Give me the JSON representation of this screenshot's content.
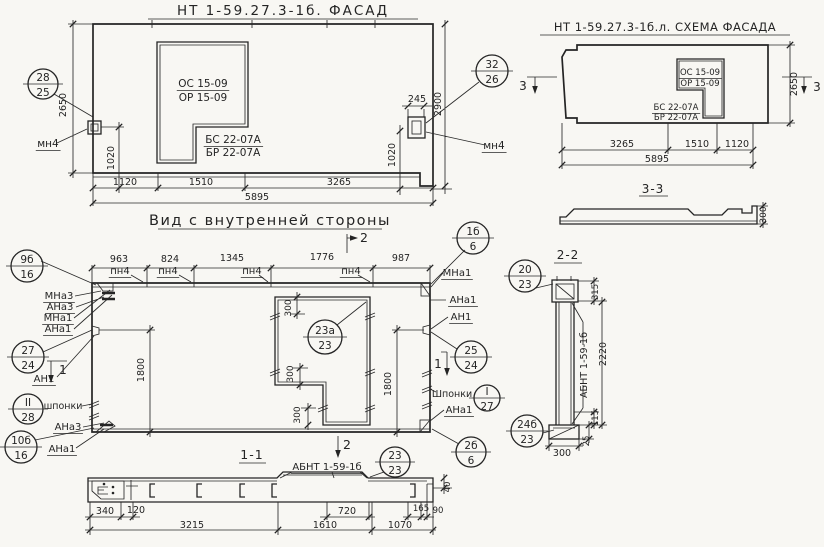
{
  "meta": {
    "drawing_type": "panel working drawing (facade, inner view, sections)",
    "paper_color": "#f8f7f3",
    "ink_color": "#242424"
  },
  "labels": [
    {
      "id": "title-facade",
      "text": "НТ 1-59.27.3-1б. ФАСАД",
      "x": 283,
      "y": 15,
      "size": 13.5,
      "ls": 2
    },
    {
      "id": "title-scheme",
      "text": "НТ 1-59.27.3-1б.л. СХЕМА ФАСАДА",
      "x": 665,
      "y": 31,
      "size": 11.5,
      "ls": 0.5
    },
    {
      "id": "title-inner-view",
      "text": "Вид с внутренней стороны",
      "x": 270,
      "y": 225,
      "size": 14.5,
      "ls": 1.5
    },
    {
      "id": "title-section-1-1",
      "text": "1-1",
      "x": 252,
      "y": 459,
      "size": 12.5,
      "ls": 1
    },
    {
      "id": "title-section-2-2",
      "text": "2-2",
      "x": 568,
      "y": 259,
      "size": 12,
      "ls": 1
    },
    {
      "id": "title-section-3-3",
      "text": "3-3",
      "x": 653,
      "y": 193,
      "size": 12,
      "ls": 1
    },
    {
      "id": "facade-os-mark",
      "text": "ОС 15-09",
      "x": 203,
      "y": 87,
      "size": 10.5,
      "u": true
    },
    {
      "id": "facade-or-mark",
      "text": "ОР 15-09",
      "x": 203,
      "y": 101,
      "size": 10.5
    },
    {
      "id": "facade-bs-mark",
      "text": "БС 22-07А",
      "x": 233,
      "y": 143,
      "size": 10.5,
      "u": true
    },
    {
      "id": "facade-br-mark",
      "text": "БР 22-07А",
      "x": 233,
      "y": 156,
      "size": 10.5
    },
    {
      "id": "facade-mn4-left",
      "text": "мн4",
      "x": 48,
      "y": 147,
      "size": 10.5,
      "u": true
    },
    {
      "id": "facade-mn4-right",
      "text": "мн4",
      "x": 494,
      "y": 149,
      "size": 10.5,
      "u": true
    },
    {
      "id": "facade-dim-1120",
      "text": "1120",
      "x": 125,
      "y": 185,
      "size": 9.5
    },
    {
      "id": "facade-dim-1510",
      "text": "1510",
      "x": 201,
      "y": 185,
      "size": 9.5
    },
    {
      "id": "facade-dim-3265",
      "text": "3265",
      "x": 339,
      "y": 185,
      "size": 9.5
    },
    {
      "id": "facade-dim-5895",
      "text": "5895",
      "x": 257,
      "y": 200,
      "size": 9.5
    },
    {
      "id": "facade-dim-2650",
      "text": "2650",
      "x": 66,
      "y": 105,
      "size": 9.5,
      "rot": -90
    },
    {
      "id": "facade-dim-1020-left",
      "text": "1020",
      "x": 114,
      "y": 158,
      "size": 9.5,
      "rot": -90
    },
    {
      "id": "facade-dim-245",
      "text": "245",
      "x": 417,
      "y": 102,
      "size": 9.5
    },
    {
      "id": "facade-dim-2900",
      "text": "2900",
      "x": 441,
      "y": 104,
      "size": 9.5,
      "rot": -90
    },
    {
      "id": "facade-dim-1020-right",
      "text": "1020",
      "x": 395,
      "y": 155,
      "size": 9.5,
      "rot": -90
    },
    {
      "id": "scheme-os-mark",
      "text": "ОС 15-09",
      "x": 700,
      "y": 75,
      "size": 8.5,
      "u": true
    },
    {
      "id": "scheme-or-mark",
      "text": "ОР 15-09",
      "x": 700,
      "y": 86,
      "size": 8.5
    },
    {
      "id": "scheme-bs-mark",
      "text": "БС 22-07А",
      "x": 676,
      "y": 110,
      "size": 8.5,
      "u": true
    },
    {
      "id": "scheme-br-mark",
      "text": "БР 22-07А",
      "x": 676,
      "y": 120,
      "size": 8.5
    },
    {
      "id": "scheme-dim-2650",
      "text": "2650",
      "x": 797,
      "y": 84,
      "size": 9.5,
      "rot": -90
    },
    {
      "id": "scheme-dim-3265",
      "text": "3265",
      "x": 622,
      "y": 147,
      "size": 9.5
    },
    {
      "id": "scheme-dim-1510",
      "text": "1510",
      "x": 697,
      "y": 147,
      "size": 9.5
    },
    {
      "id": "scheme-dim-1120",
      "text": "1120",
      "x": 737,
      "y": 147,
      "size": 9.5
    },
    {
      "id": "scheme-dim-5895",
      "text": "5895",
      "x": 657,
      "y": 162,
      "size": 9.5
    },
    {
      "id": "scheme-marker-3-left",
      "text": "3",
      "x": 523,
      "y": 90,
      "size": 12
    },
    {
      "id": "scheme-marker-3-right",
      "text": "3",
      "x": 817,
      "y": 91,
      "size": 12
    },
    {
      "id": "section33-dim-300",
      "text": "300",
      "x": 766,
      "y": 215,
      "size": 9,
      "rot": -90
    },
    {
      "id": "inner-dim-963",
      "text": "963",
      "x": 119,
      "y": 262,
      "size": 9.5
    },
    {
      "id": "inner-dim-824",
      "text": "824",
      "x": 170,
      "y": 262,
      "size": 9.5
    },
    {
      "id": "inner-dim-1345",
      "text": "1345",
      "x": 232,
      "y": 261,
      "size": 9.5
    },
    {
      "id": "inner-dim-1776",
      "text": "1776",
      "x": 322,
      "y": 260,
      "size": 9.5
    },
    {
      "id": "inner-dim-987",
      "text": "987",
      "x": 401,
      "y": 261,
      "size": 9.5
    },
    {
      "id": "inner-pn4-a",
      "text": "пн4",
      "x": 120,
      "y": 274,
      "size": 10,
      "u": true
    },
    {
      "id": "inner-pn4-b",
      "text": "пн4",
      "x": 168,
      "y": 274,
      "size": 10,
      "u": true
    },
    {
      "id": "inner-pn4-c",
      "text": "пн4",
      "x": 252,
      "y": 274,
      "size": 10,
      "u": true
    },
    {
      "id": "inner-pn4-d",
      "text": "пн4",
      "x": 351,
      "y": 274,
      "size": 10,
      "u": true
    },
    {
      "id": "marker-2-top",
      "text": "2",
      "x": 364,
      "y": 242,
      "size": 12.5
    },
    {
      "id": "marker-2-bottom",
      "text": "2",
      "x": 347,
      "y": 449,
      "size": 12.5
    },
    {
      "id": "inner-mna1-right",
      "text": "МНа1",
      "x": 457,
      "y": 276,
      "size": 10,
      "u": true
    },
    {
      "id": "inner-ana1-right-top",
      "text": "АНа1",
      "x": 463,
      "y": 303,
      "size": 10,
      "u": true
    },
    {
      "id": "inner-an1-right",
      "text": "АН1",
      "x": 461,
      "y": 320,
      "size": 10,
      "u": true
    },
    {
      "id": "inner-shponki-right",
      "text": "Шпонки",
      "x": 452,
      "y": 397,
      "size": 9.5
    },
    {
      "id": "inner-ana1-right-bottom",
      "text": "АНа1",
      "x": 459,
      "y": 413,
      "size": 10,
      "u": true
    },
    {
      "id": "inner-mna3-left",
      "text": "МНа3",
      "x": 59,
      "y": 299,
      "size": 10,
      "u": true
    },
    {
      "id": "inner-ana3-left",
      "text": "АНа3",
      "x": 60,
      "y": 310,
      "size": 10,
      "u": true
    },
    {
      "id": "inner-mna1-left",
      "text": "МНа1",
      "x": 58,
      "y": 321,
      "size": 10,
      "u": true
    },
    {
      "id": "inner-ana1-left",
      "text": "АНа1",
      "x": 58,
      "y": 332,
      "size": 10,
      "u": true
    },
    {
      "id": "inner-an1-left",
      "text": "АН1",
      "x": 44,
      "y": 382,
      "size": 10,
      "u": true
    },
    {
      "id": "inner-shponki-left",
      "text": "шпонки",
      "x": 63,
      "y": 409,
      "size": 9.5
    },
    {
      "id": "inner-ana3-left-bottom",
      "text": "АНа3",
      "x": 68,
      "y": 430,
      "size": 10,
      "u": true
    },
    {
      "id": "inner-ana1-left-bottom",
      "text": "АНа1",
      "x": 62,
      "y": 452,
      "size": 10,
      "u": true
    },
    {
      "id": "marker-1-left",
      "text": "1",
      "x": 63,
      "y": 374,
      "size": 12
    },
    {
      "id": "marker-1-right",
      "text": "1",
      "x": 438,
      "y": 368,
      "size": 12
    },
    {
      "id": "inner-dim-1800-left",
      "text": "1800",
      "x": 144,
      "y": 370,
      "size": 9.5,
      "rot": -90
    },
    {
      "id": "inner-dim-1800-right",
      "text": "1800",
      "x": 391,
      "y": 384,
      "size": 9.5,
      "rot": -90
    },
    {
      "id": "inner-dim-300-top",
      "text": "300",
      "x": 291,
      "y": 308,
      "size": 9,
      "rot": -90
    },
    {
      "id": "inner-dim-300-mid",
      "text": "300",
      "x": 293,
      "y": 374,
      "size": 9,
      "rot": -90
    },
    {
      "id": "inner-dim-300-bottom",
      "text": "300",
      "x": 300,
      "y": 415,
      "size": 9,
      "rot": -90
    },
    {
      "id": "sec11-abnt-mark",
      "text": "АБНТ 1-59-1б",
      "x": 327,
      "y": 470,
      "size": 10,
      "u": true
    },
    {
      "id": "sec11-dim-340",
      "text": "340",
      "x": 105,
      "y": 514,
      "size": 9.5
    },
    {
      "id": "sec11-dim-120",
      "text": "120",
      "x": 136,
      "y": 513,
      "size": 9.5
    },
    {
      "id": "sec11-dim-3215",
      "text": "3215",
      "x": 192,
      "y": 528,
      "size": 9.5
    },
    {
      "id": "sec11-dim-720",
      "text": "720",
      "x": 347,
      "y": 514,
      "size": 9.5
    },
    {
      "id": "sec11-dim-1610",
      "text": "1610",
      "x": 325,
      "y": 528,
      "size": 9.5
    },
    {
      "id": "sec11-dim-165",
      "text": "165",
      "x": 421,
      "y": 511,
      "size": 8.5
    },
    {
      "id": "sec11-dim-90",
      "text": "90",
      "x": 438,
      "y": 513,
      "size": 8.5
    },
    {
      "id": "sec11-dim-1070",
      "text": "1070",
      "x": 400,
      "y": 528,
      "size": 9.5
    },
    {
      "id": "sec11-dim-40",
      "text": "40",
      "x": 450,
      "y": 487,
      "size": 8.5,
      "rot": -90
    },
    {
      "id": "sec22-dim-315",
      "text": "315",
      "x": 598,
      "y": 292,
      "size": 8.5,
      "rot": -90
    },
    {
      "id": "sec22-dim-2220",
      "text": "2220",
      "x": 606,
      "y": 354,
      "size": 9.5,
      "rot": -90
    },
    {
      "id": "sec22-abnt-mark",
      "text": "АБНТ 1-59-1б",
      "x": 587,
      "y": 365,
      "size": 9.5,
      "rot": -90
    },
    {
      "id": "sec22-dim-115",
      "text": "115",
      "x": 598,
      "y": 418,
      "size": 8.5,
      "rot": -90
    },
    {
      "id": "sec22-dim-25",
      "text": "25",
      "x": 589,
      "y": 441,
      "size": 8.5,
      "rot": -90
    },
    {
      "id": "sec22-dim-300",
      "text": "300",
      "x": 562,
      "y": 456,
      "size": 9.5
    }
  ],
  "callouts": [
    {
      "id": "callout-28-25",
      "top": "28",
      "bottom": "25",
      "cx": 43,
      "cy": 84,
      "r": 15
    },
    {
      "id": "callout-32-26",
      "top": "32",
      "bottom": "26",
      "cx": 492,
      "cy": 71,
      "r": 16
    },
    {
      "id": "callout-9b-16",
      "top": "9б",
      "bottom": "16",
      "cx": 27,
      "cy": 266,
      "r": 16
    },
    {
      "id": "callout-1b-6",
      "top": "1б",
      "bottom": "6",
      "cx": 473,
      "cy": 238,
      "r": 16
    },
    {
      "id": "callout-27-24",
      "top": "27",
      "bottom": "24",
      "cx": 28,
      "cy": 357,
      "r": 16
    },
    {
      "id": "callout-II-28",
      "top": "II",
      "bottom": "28",
      "cx": 28,
      "cy": 409,
      "r": 15
    },
    {
      "id": "callout-10b-16",
      "top": "10б",
      "bottom": "16",
      "cx": 21,
      "cy": 447,
      "r": 16
    },
    {
      "id": "callout-20-23",
      "top": "20",
      "bottom": "23",
      "cx": 525,
      "cy": 276,
      "r": 16
    },
    {
      "id": "callout-25-24",
      "top": "25",
      "bottom": "24",
      "cx": 471,
      "cy": 357,
      "r": 16
    },
    {
      "id": "callout-I-27",
      "top": "I",
      "bottom": "27",
      "cx": 487,
      "cy": 398,
      "r": 13
    },
    {
      "id": "callout-24b-23",
      "top": "24б",
      "bottom": "23",
      "cx": 527,
      "cy": 431,
      "r": 16
    },
    {
      "id": "callout-2b-6",
      "top": "2б",
      "bottom": "6",
      "cx": 471,
      "cy": 452,
      "r": 15
    },
    {
      "id": "callout-23a-23",
      "top": "23а",
      "bottom": "23",
      "cx": 325,
      "cy": 337,
      "r": 17
    },
    {
      "id": "callout-23-23",
      "top": "23",
      "bottom": "23",
      "cx": 395,
      "cy": 462,
      "r": 15
    }
  ]
}
